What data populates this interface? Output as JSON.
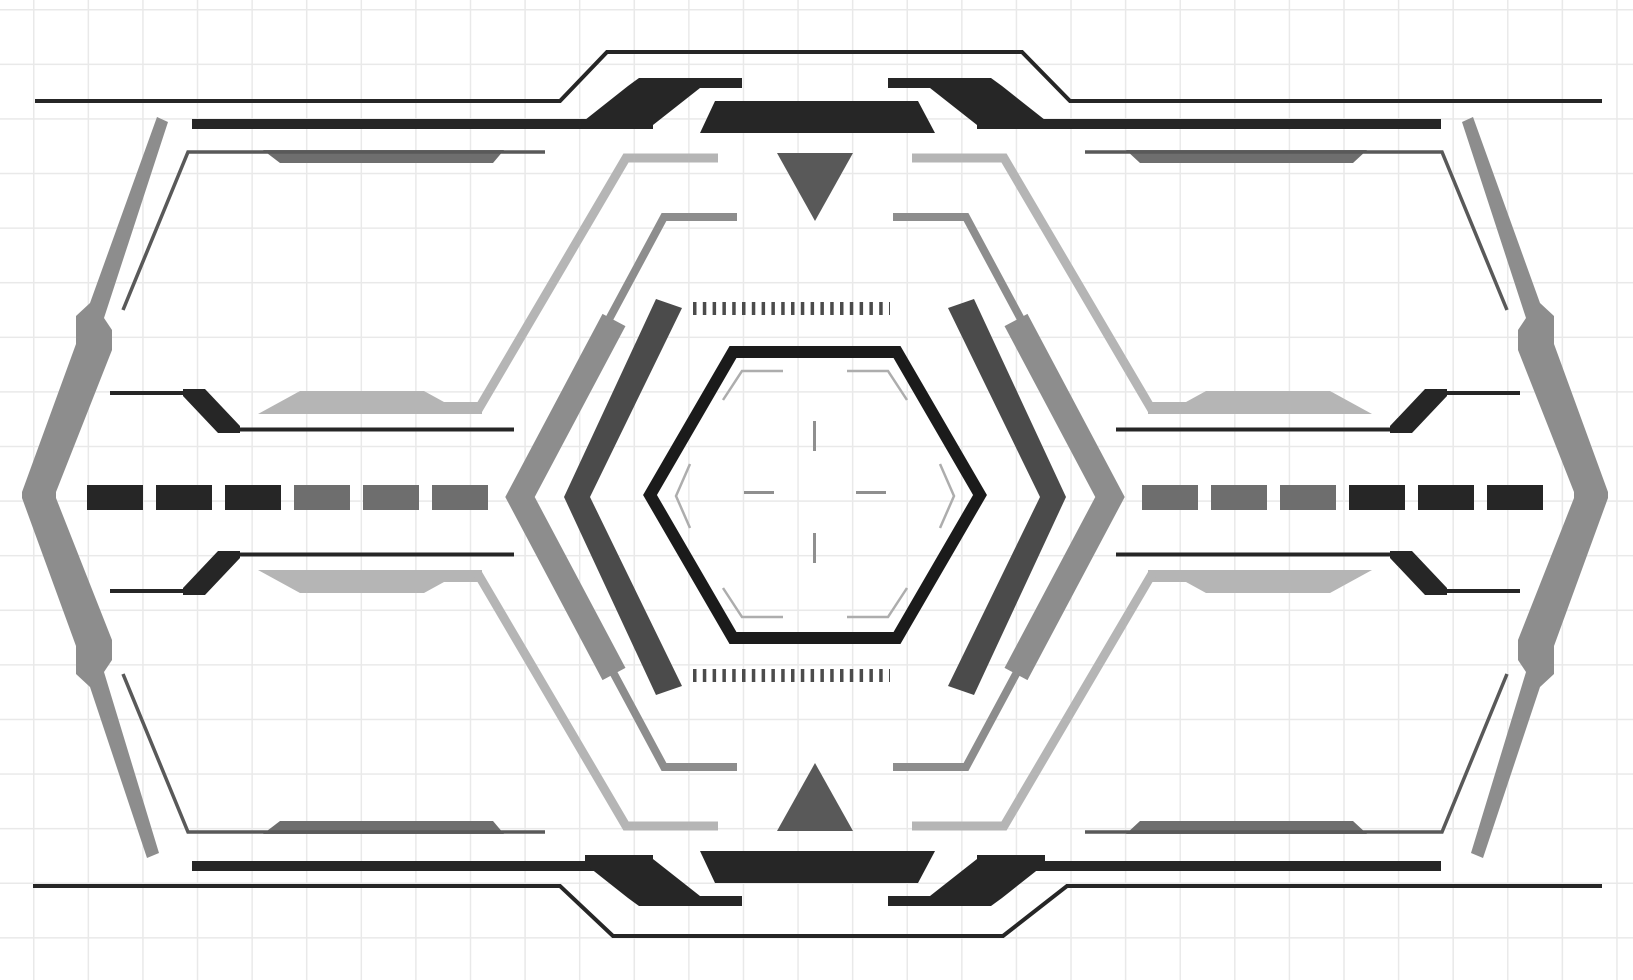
{
  "meta": {
    "title": "Sci-fi HUD frame interface",
    "description": "Futuristic black and gray wireframe HUD overlay on white grid paper, mirrored horizontally and vertically, with central hexagon reticle",
    "width_px": 1633,
    "height_px": 980
  },
  "palette": {
    "bg": "#ffffff",
    "grid": "#e9e9e9",
    "ink": "#262626",
    "hex_black": "#1b1b1b",
    "dark_gray": "#4b4b4b",
    "slate": "#595959",
    "mid_gray": "#6e6e6e",
    "chev_gray": "#8d8d8d",
    "light_gray": "#b5b5b5",
    "accent_gray": "#adadad",
    "cross_gray": "#8f8f8f"
  },
  "components": {
    "outer_frame": {
      "top_outline": "thin black octagonal outline raised over center",
      "bottom_outline": "mirrored thin black outline dipped under center",
      "thick_bars": 4,
      "wing_shapes": 4,
      "center_trapezoids": 2
    },
    "inner_frame": {
      "corner_lines": 4,
      "thick_segments": 4
    },
    "side_brackets": {
      "left": "large gray angle bracket pointing left",
      "right": "large gray angle bracket pointing right"
    },
    "dash_rows": {
      "row_y_center": 497,
      "dash_width": 56,
      "dash_height": 25,
      "left": {
        "count": 6,
        "colors": [
          "ink",
          "ink",
          "ink",
          "mid_gray",
          "mid_gray",
          "mid_gray"
        ]
      },
      "right": {
        "count": 6,
        "colors": [
          "mid_gray",
          "mid_gray",
          "mid_gray",
          "ink",
          "ink",
          "ink"
        ]
      }
    },
    "rings": {
      "outer_light_ring_stroke": 9,
      "middle_gray_ring_stroke": 8,
      "thick_chevron_stroke": 26,
      "dark_chevrons": 2
    },
    "hexagon": {
      "stroke": 12,
      "corner_accents": 6,
      "crosshair_lines": 4
    },
    "tick_strips": {
      "rows": 2,
      "ticks_per_row": 20
    },
    "triangles": {
      "top": "down-arrow",
      "bottom": "up-arrow"
    }
  }
}
